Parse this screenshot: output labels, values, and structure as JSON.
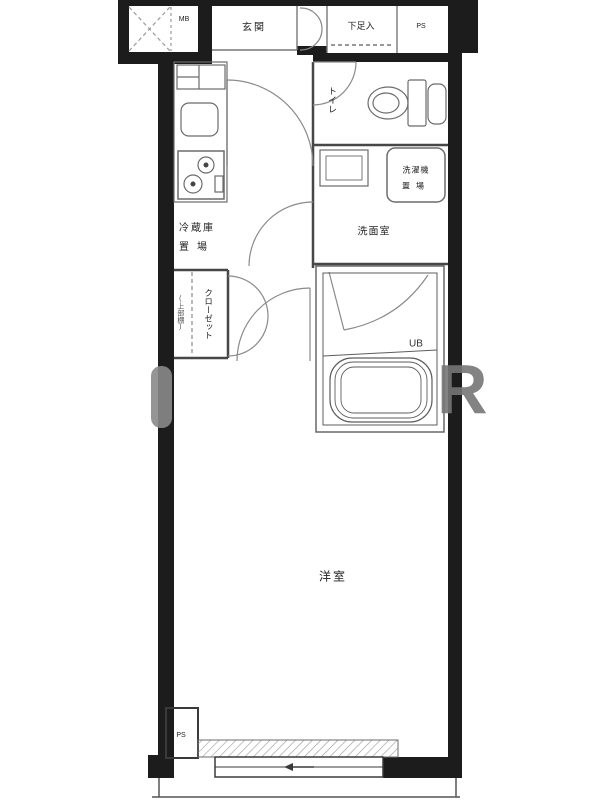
{
  "labels": {
    "meter_box": "MB",
    "entrance": "玄関",
    "shoe_cabinet": "下足入",
    "pipe_space_top": "PS",
    "toilet": "トイレ",
    "washer_place": {
      "line1": "洗濯機",
      "line2": "置場"
    },
    "washroom": "洗面室",
    "fridge_place": {
      "line1": "冷蔵庫",
      "line2": "置場"
    },
    "closet": "クローゼット",
    "closet_note": "(上部棚)",
    "unit_bath": "UB",
    "western_room": "洋室",
    "pipe_space_bottom": "PS"
  },
  "watermark": {
    "letter": "R"
  },
  "colors": {
    "wall": "#1c1c1c",
    "partition": "#474747",
    "fixture": "#6b6b6b",
    "door": "#8a8a8a",
    "background": "#ffffff"
  }
}
